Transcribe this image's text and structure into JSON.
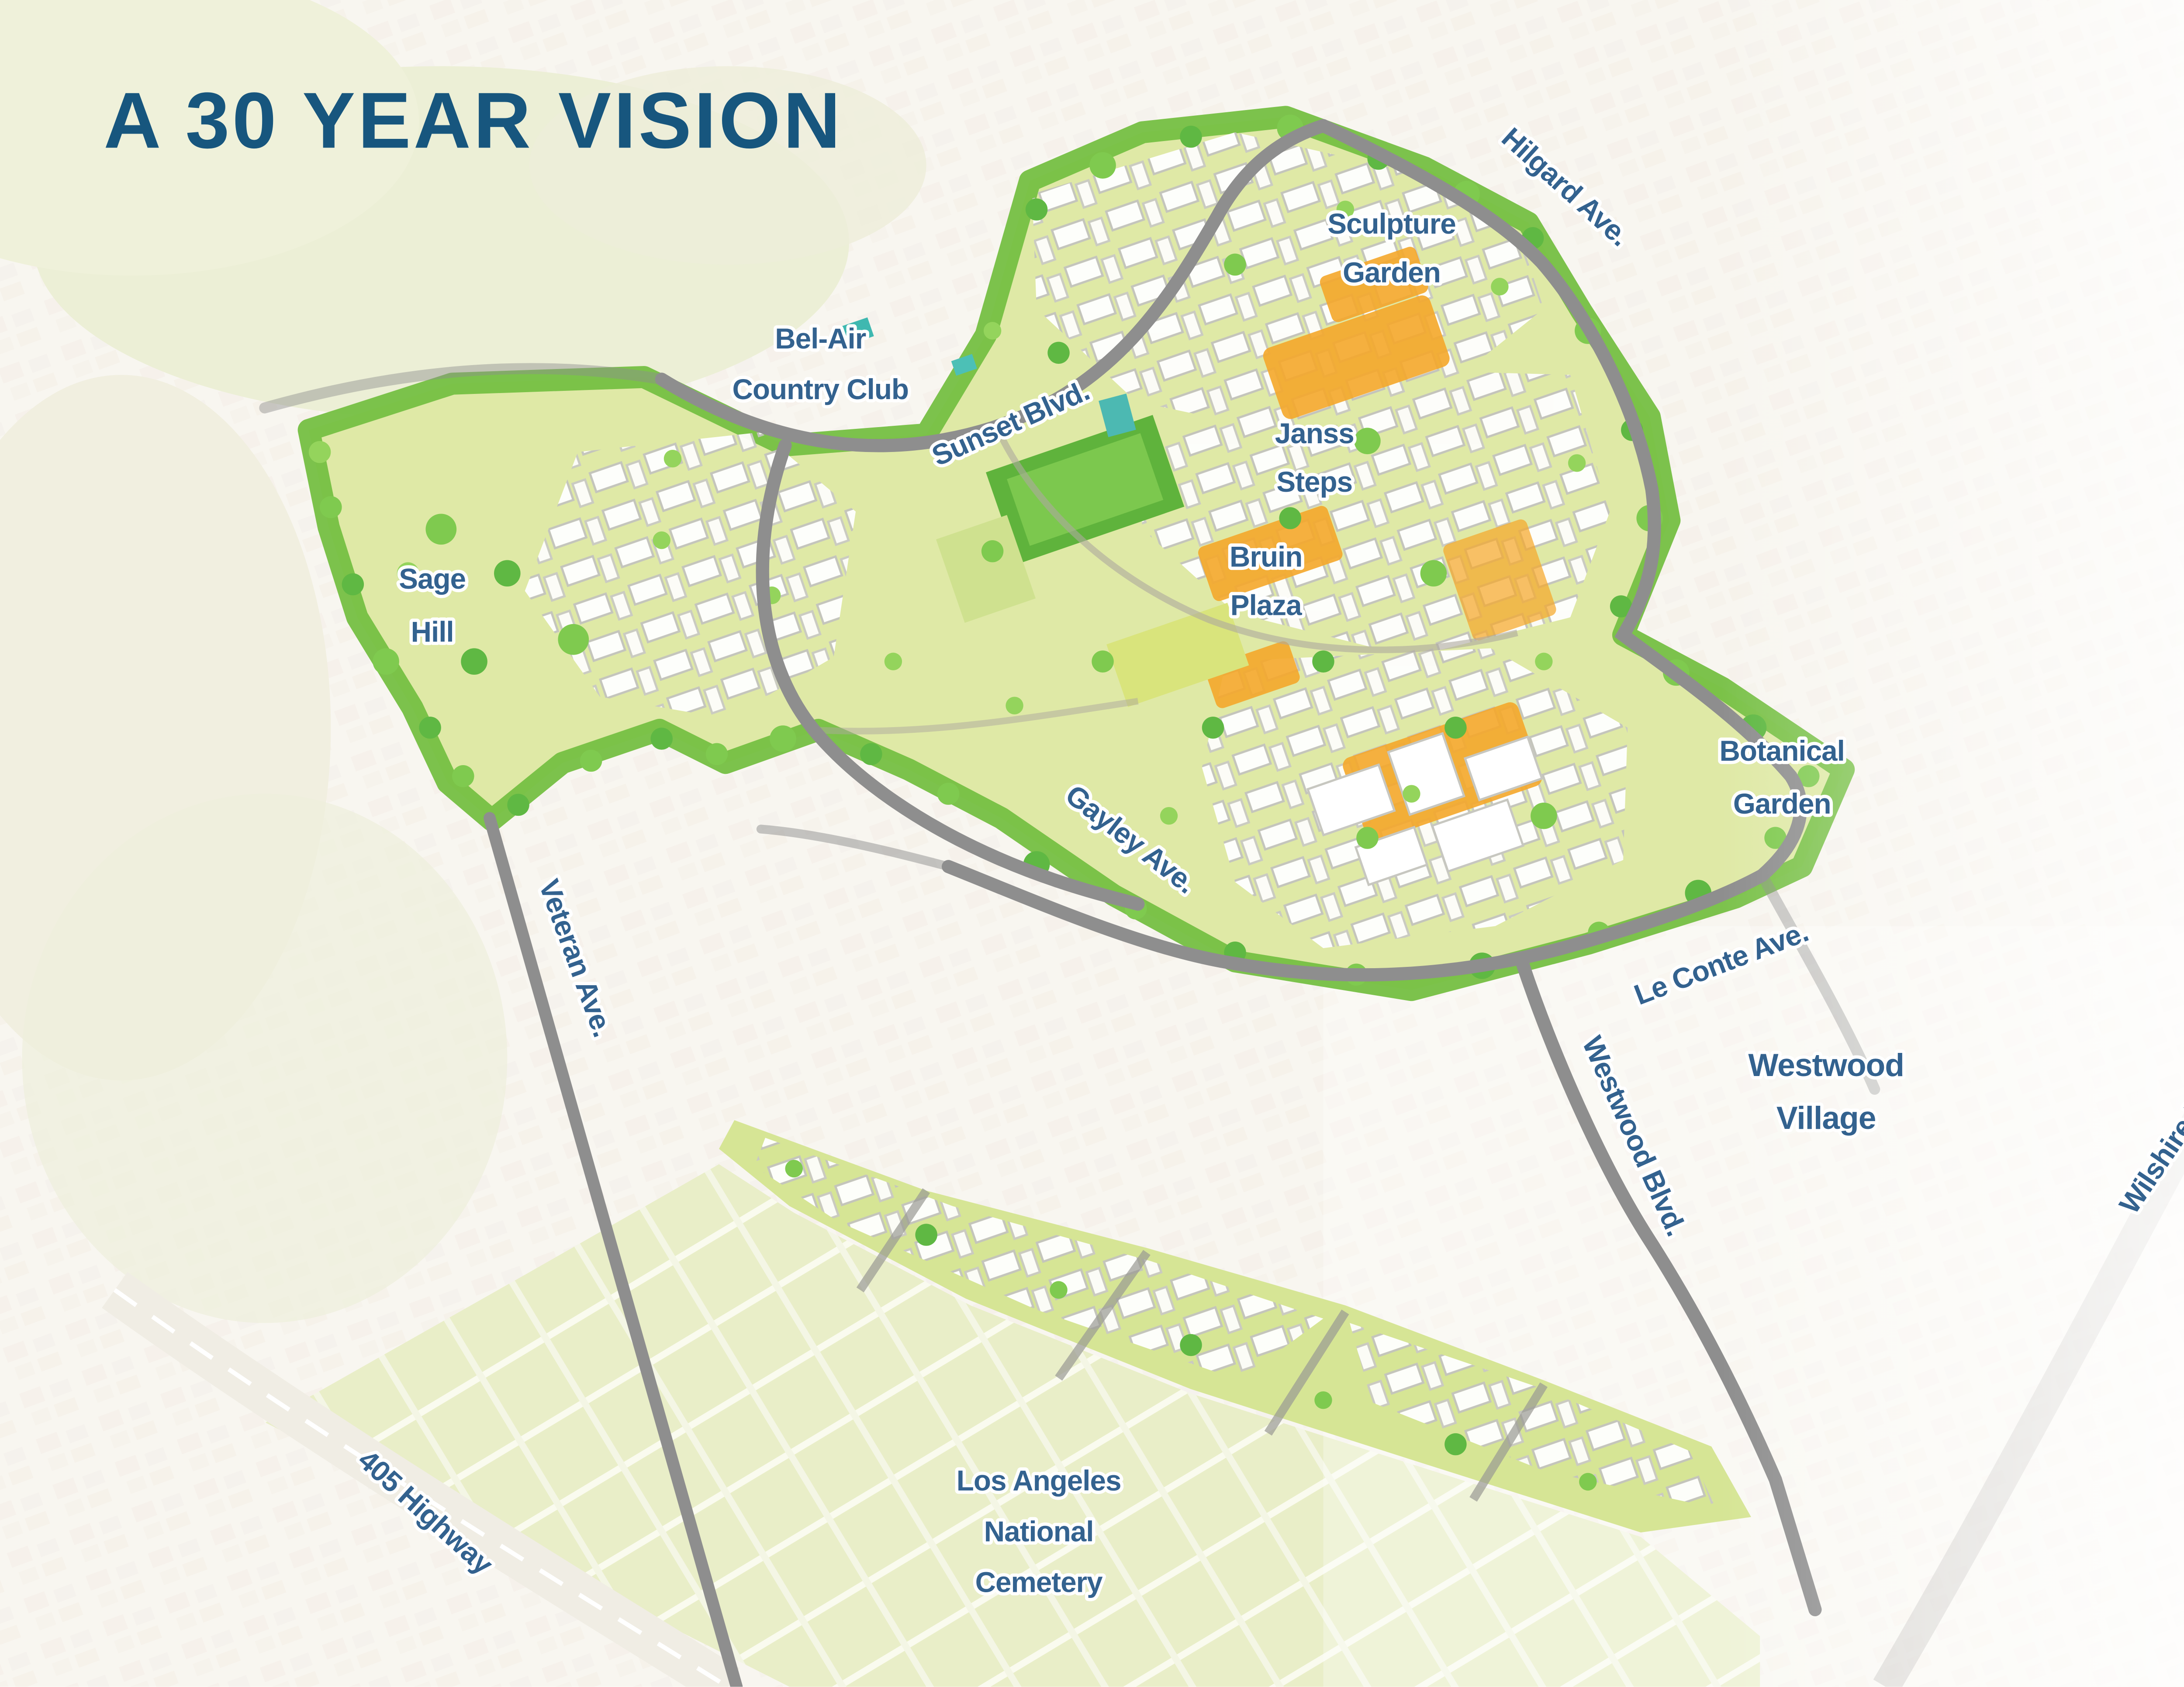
{
  "title": "A 30 YEAR VISION",
  "map": {
    "labels": [
      {
        "id": "sculpture-garden",
        "lines": [
          "Sculpture",
          "Garden"
        ]
      },
      {
        "id": "hilgard-ave",
        "lines": [
          "Hilgard Ave."
        ]
      },
      {
        "id": "bel-air-country-club",
        "lines": [
          "Bel-Air",
          "Country Club"
        ]
      },
      {
        "id": "sunset-blvd",
        "lines": [
          "Sunset Blvd."
        ]
      },
      {
        "id": "janss-steps",
        "lines": [
          "Janss",
          "Steps"
        ]
      },
      {
        "id": "bruin-plaza",
        "lines": [
          "Bruin",
          "Plaza"
        ]
      },
      {
        "id": "sage-hill",
        "lines": [
          "Sage",
          "Hill"
        ]
      },
      {
        "id": "botanical-garden",
        "lines": [
          "Botanical",
          "Garden"
        ]
      },
      {
        "id": "gayley-ave",
        "lines": [
          "Gayley Ave."
        ]
      },
      {
        "id": "veteran-ave",
        "lines": [
          "Veteran Ave."
        ]
      },
      {
        "id": "le-conte-ave",
        "lines": [
          "Le Conte Ave."
        ]
      },
      {
        "id": "westwood-village",
        "lines": [
          "Westwood",
          "Village"
        ]
      },
      {
        "id": "westwood-blvd",
        "lines": [
          "Westwood Blvd."
        ]
      },
      {
        "id": "wilshire-blvd",
        "lines": [
          "Wilshire Blvd."
        ]
      },
      {
        "id": "405-highway",
        "lines": [
          "405 Highway"
        ]
      },
      {
        "id": "la-national-cemetery",
        "lines": [
          "Los Angeles",
          "National",
          "Cemetery"
        ]
      }
    ]
  },
  "stats": [
    {
      "icon": "native-planting-icon",
      "heading_lines": [
        "NATIVE PLANTING",
        "TARGET"
      ],
      "value": "75%",
      "caption": "OF THE TOTAL PLANTING AREA"
    },
    {
      "icon": "biodiversity-icon",
      "heading_lines": [
        "BIODIVERSITY",
        "TARGET"
      ],
      "value": "30%",
      "caption": "OF THE TOTAL LAND"
    },
    {
      "icon": "turf-reduction-icon",
      "heading_lines": [
        "TURF",
        "REDUCTION"
      ],
      "value": "65%",
      "caption": "OF THE EXISTING TURF AREA"
    },
    {
      "icon": "irrigation-icon",
      "heading_lines": [
        "IRRIGATION WATER",
        "USE REDUCTION"
      ],
      "value": "31.4 M",
      "caption": "GALLONS PER YEAR"
    }
  ],
  "colors": {
    "accent_green": "#a6c843",
    "accent_blue": "#1d5c8f",
    "title_blue": "#17567e",
    "map_label_blue": "#33628f",
    "campus_tree_green": "#76c044",
    "campus_ground_orange": "#f5a82b"
  }
}
